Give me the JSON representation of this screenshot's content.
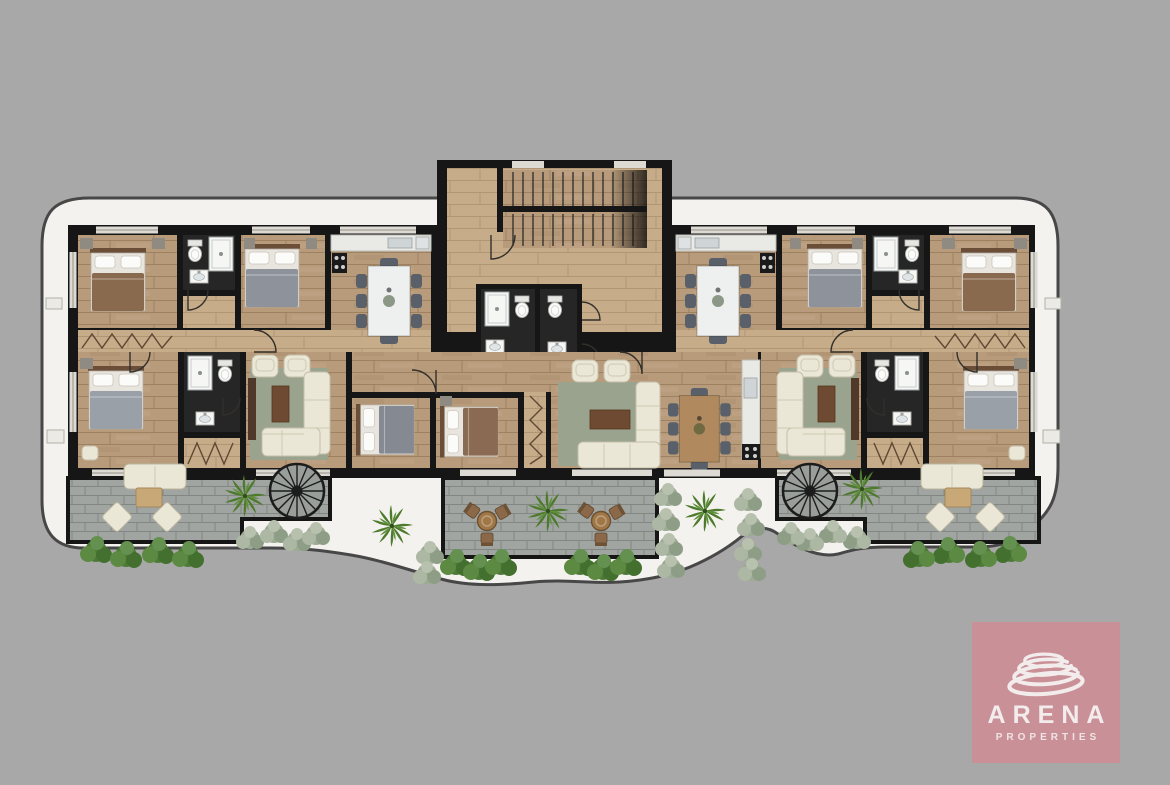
{
  "brand": {
    "name": "ARENA",
    "tagline": "PROPERTIES"
  },
  "palette": {
    "background": "#a8a8a8",
    "plot": "#f3f2ee",
    "plot_outline": "#474747",
    "wall": "#161616",
    "wood": "#b89b7a",
    "wood_light": "#c7ac8a",
    "bath_floor": "#262626",
    "terrace": "#a0a5a2",
    "window": "#dcdad2",
    "rug": "#9aa38d",
    "cream": "#ebe7d7",
    "chair_gray": "#596069",
    "wood_dark": "#8a6648",
    "fixture": "#f6f6f4",
    "bush_green": "#55803f",
    "bush_sage": "#a3ae9c",
    "logo_bg": "#c99097",
    "logo_fg": "#f3ecec"
  },
  "plan_summary": {
    "bedrooms_visible": 8,
    "bathrooms_visible": 6,
    "dining_sets": 3,
    "terraces": 3,
    "spiral_staircases": 2,
    "outdoor_lounge_sets": 2,
    "outdoor_bistro_sets": 2,
    "central_staircase_flights": 2
  }
}
